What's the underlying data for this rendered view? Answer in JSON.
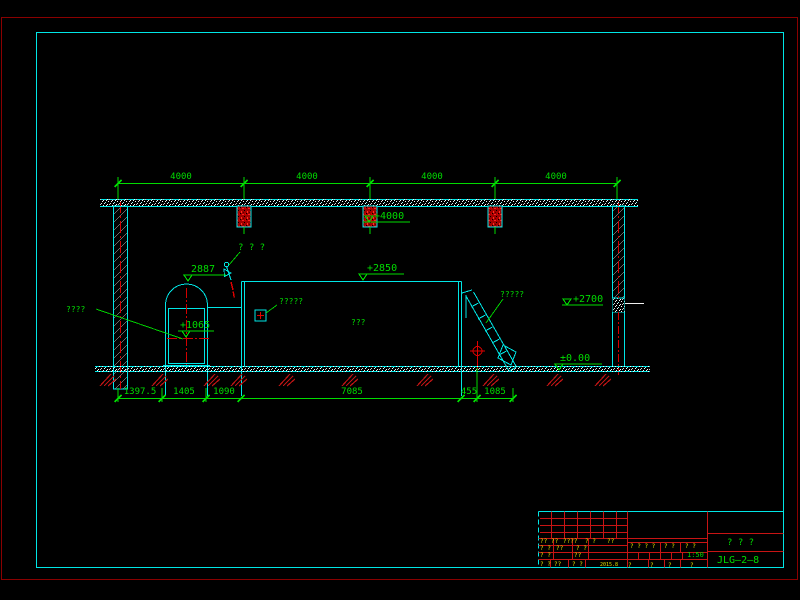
{
  "colors": {
    "green": "#00dc00",
    "cyan": "#00e6e6",
    "red": "#e00000",
    "center_red": "#d40000",
    "border_red": "#8a0000",
    "grid_red": "#c81414",
    "yellow": "#e0e000",
    "white": "#f0f0f0"
  },
  "drawing": {
    "top_dimensions": {
      "labels": [
        "4000",
        "4000",
        "4000",
        "4000"
      ],
      "positions": [
        181,
        307,
        432,
        556
      ],
      "y": 179
    },
    "bottom_dimensions": {
      "labels": [
        "1397.5",
        "1405",
        "1090",
        "7085",
        "455",
        "1085"
      ],
      "positions": [
        140,
        184,
        224,
        352,
        469,
        495
      ],
      "y": 394
    },
    "levels": [
      {
        "name": "level-plus4000",
        "text": "+4000",
        "tx": 374,
        "ty": 219,
        "ul": [
          363,
          410,
          222
        ],
        "tri": [
          369,
          222
        ]
      },
      {
        "name": "level-2887",
        "text": "2887",
        "tx": 191,
        "ty": 272,
        "ul": [
          183,
          226,
          275
        ],
        "tri": [
          188,
          281
        ]
      },
      {
        "name": "level-plus2850",
        "text": "+2850",
        "tx": 367,
        "ty": 271,
        "ul": [
          360,
          404,
          274
        ],
        "tri": [
          363,
          280
        ]
      },
      {
        "name": "level-plus2700",
        "text": "+2700",
        "tx": 573,
        "ty": 302,
        "ul": [
          562,
          603,
          305
        ],
        "tri": [
          567,
          305
        ]
      },
      {
        "name": "level-zero",
        "text": "±0.00",
        "tx": 560,
        "ty": 361,
        "ul": [
          554,
          602,
          364
        ],
        "tri": [
          559,
          370
        ]
      },
      {
        "name": "level-plus1065",
        "text": "+1065",
        "tx": 180,
        "ty": 328,
        "ul": [
          178,
          214,
          331
        ],
        "tri": [
          186,
          337
        ]
      }
    ],
    "labels": [
      {
        "name": "label-valve",
        "text": "? ? ?",
        "x": 238,
        "y": 250,
        "size": 9
      },
      {
        "name": "label-vessel",
        "text": "????",
        "x": 66,
        "y": 312,
        "size": 8
      },
      {
        "name": "label-nozzle",
        "text": "?????",
        "x": 279,
        "y": 304,
        "size": 8
      },
      {
        "name": "label-tank",
        "text": "???",
        "x": 351,
        "y": 325,
        "size": 8
      },
      {
        "name": "label-ladder",
        "text": "?????",
        "x": 500,
        "y": 297,
        "size": 8
      }
    ]
  },
  "title_block": {
    "texts": [
      {
        "text": "??",
        "x": 540,
        "y": 543
      },
      {
        "text": "??",
        "x": 551,
        "y": 543
      },
      {
        "text": "????",
        "x": 563,
        "y": 543
      },
      {
        "text": "? ?",
        "x": 585,
        "y": 543
      },
      {
        "text": "??",
        "x": 607,
        "y": 543
      },
      {
        "text": "? ?",
        "x": 540,
        "y": 550
      },
      {
        "text": "??",
        "x": 556,
        "y": 550
      },
      {
        "text": "? ?",
        "x": 576,
        "y": 550
      },
      {
        "text": "? ?",
        "x": 540,
        "y": 557
      },
      {
        "text": "??",
        "x": 574,
        "y": 557
      },
      {
        "text": "? ?",
        "x": 540,
        "y": 566
      },
      {
        "text": "??",
        "x": 554,
        "y": 566
      },
      {
        "text": "? ?",
        "x": 572,
        "y": 566
      },
      {
        "text": "2015.8",
        "x": 600,
        "y": 566,
        "size": 5,
        "name": "date-text"
      },
      {
        "text": "? ? ? ?",
        "x": 630,
        "y": 548
      },
      {
        "text": "? ?",
        "x": 664,
        "y": 548
      },
      {
        "text": "? ?",
        "x": 685,
        "y": 548
      },
      {
        "text": "?",
        "x": 628,
        "y": 567
      },
      {
        "text": "?",
        "x": 650,
        "y": 567
      },
      {
        "text": "?",
        "x": 668,
        "y": 567
      },
      {
        "text": "?",
        "x": 690,
        "y": 567
      },
      {
        "text": "1:50",
        "x": 687,
        "y": 557,
        "color": "green",
        "size": 7,
        "name": "scale-value"
      },
      {
        "text": "? ? ?",
        "x": 727,
        "y": 545,
        "color": "green",
        "size": 9,
        "name": "drawing-title"
      },
      {
        "text": "JLG—2—8",
        "x": 717,
        "y": 563,
        "color": "green",
        "size": 10,
        "name": "drawing-number"
      }
    ]
  }
}
